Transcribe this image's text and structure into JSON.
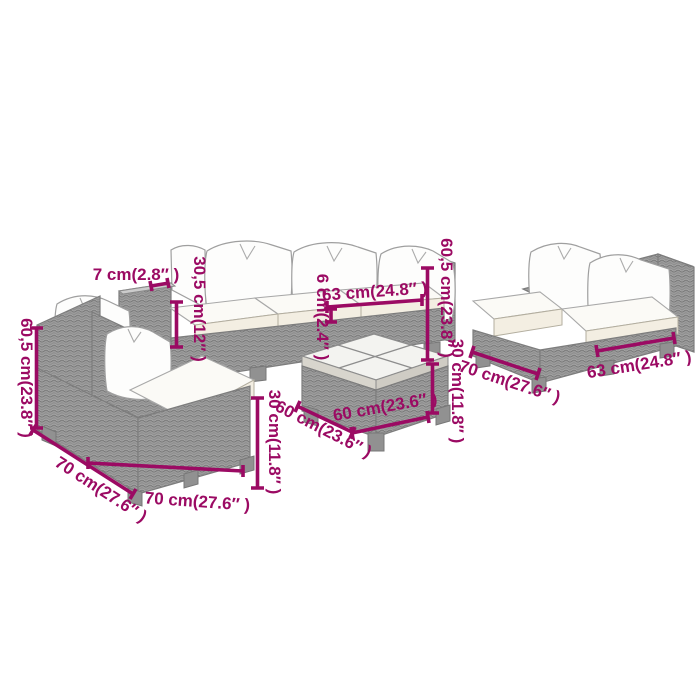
{
  "product_diagram": {
    "type": "furniture-dimension-diagram",
    "background_color": "#ffffff",
    "annotation_color": "#9b0a63",
    "furniture_colors": {
      "rattan": "#9e9e9e",
      "outline": "#7d7d7d",
      "cushion": "#ffffff",
      "seat_front": "#f3eee2"
    },
    "pieces": [
      {
        "name": "three-seat-sofa-top"
      },
      {
        "name": "two-seat-sofa-right"
      },
      {
        "name": "corner-sofa-left"
      },
      {
        "name": "coffee-table-center"
      }
    ],
    "measurements": [
      {
        "id": "top-sofa-arm-width",
        "text": "7 cm(2.8″ )",
        "orientation": "horizontal"
      },
      {
        "id": "top-sofa-arm-height",
        "text": "30,5 cm(12″ )",
        "orientation": "vertical"
      },
      {
        "id": "top-sofa-cushion-thickness",
        "text": "6 cm(2.4″ )",
        "orientation": "vertical"
      },
      {
        "id": "top-sofa-seat-width",
        "text": "63 cm(24.8″ )",
        "orientation": "horizontal"
      },
      {
        "id": "top-sofa-total-height",
        "text": "60,5 cm(23.8″ )",
        "orientation": "vertical"
      },
      {
        "id": "table-height",
        "text": "30 cm(11.8″ )",
        "orientation": "vertical"
      },
      {
        "id": "right-sofa-depth",
        "text": "70 cm(27.6″ )",
        "orientation": "diagonal"
      },
      {
        "id": "right-sofa-seat-width",
        "text": "63 cm(24.8″ )",
        "orientation": "diagonal"
      },
      {
        "id": "left-sofa-total-height",
        "text": "60,5 cm(23.8″ )",
        "orientation": "vertical"
      },
      {
        "id": "left-sofa-side-depth",
        "text": "70 cm(27.6″ )",
        "orientation": "diagonal"
      },
      {
        "id": "left-sofa-front-depth",
        "text": "70 cm(27.6″ )",
        "orientation": "horizontal"
      },
      {
        "id": "left-sofa-seat-height",
        "text": "30 cm(11.8″ )",
        "orientation": "vertical"
      },
      {
        "id": "table-side-width",
        "text": "60 cm(23.6″ )",
        "orientation": "diagonal"
      },
      {
        "id": "table-front-width",
        "text": "60 cm(23.6″ )",
        "orientation": "diagonal"
      }
    ]
  }
}
